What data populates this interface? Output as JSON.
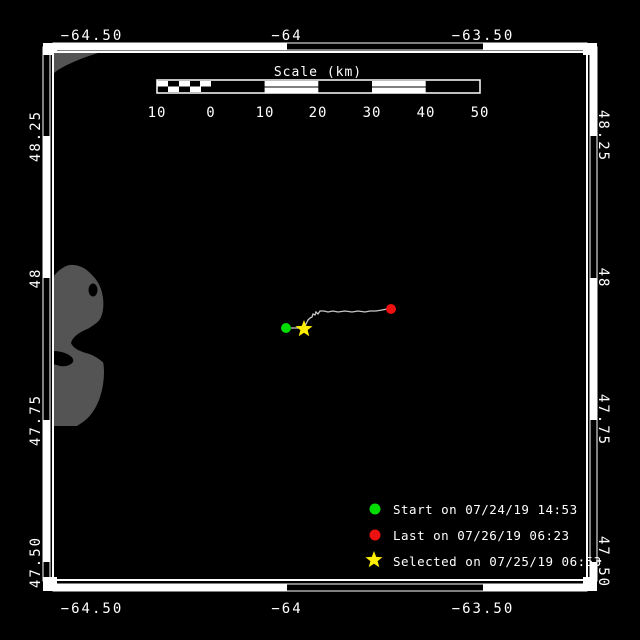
{
  "map": {
    "background": "#000000",
    "land_color": "#545454",
    "frame_color": "#ffffff",
    "lon_labels_top": [
      "−64.50",
      "−64",
      "−63.50"
    ],
    "lon_labels_bottom": [
      "−64.50",
      "−64",
      "−63.50"
    ],
    "lat_labels_left": [
      "48.25",
      "48",
      "47.75",
      "47.50"
    ],
    "lat_labels_right": [
      "48.25",
      "48",
      "47.75",
      "47.50"
    ]
  },
  "scale_bar": {
    "title": "Scale (km)",
    "ticks": [
      "10",
      "0",
      "10",
      "20",
      "30",
      "40",
      "50"
    ]
  },
  "track": {
    "line_color": "#c8c8c8",
    "points": [
      [
        286,
        328
      ],
      [
        294,
        328
      ],
      [
        300,
        328
      ],
      [
        304,
        327
      ],
      [
        306,
        324
      ],
      [
        308,
        320
      ],
      [
        310,
        318
      ],
      [
        312,
        317
      ],
      [
        313,
        314
      ],
      [
        315,
        315
      ],
      [
        316,
        312
      ],
      [
        318,
        314
      ],
      [
        320,
        311
      ],
      [
        324,
        311
      ],
      [
        328,
        312
      ],
      [
        333,
        311
      ],
      [
        338,
        312
      ],
      [
        345,
        311
      ],
      [
        352,
        312
      ],
      [
        358,
        311
      ],
      [
        365,
        312
      ],
      [
        370,
        311
      ],
      [
        376,
        311
      ],
      [
        382,
        310
      ],
      [
        387,
        309
      ],
      [
        391,
        309
      ]
    ],
    "start": {
      "x": 286,
      "y": 328,
      "color": "#00dd00"
    },
    "last": {
      "x": 391,
      "y": 309,
      "color": "#ee1111"
    },
    "selected": {
      "x": 304,
      "y": 329,
      "color": "#ffee00"
    }
  },
  "legend": {
    "items": [
      {
        "symbol": "start-dot",
        "color": "#00dd00",
        "label": "Start on 07/24/19 14:53"
      },
      {
        "symbol": "last-dot",
        "color": "#ee1111",
        "label": "Last on 07/26/19 06:23"
      },
      {
        "symbol": "selected-star",
        "color": "#ffee00",
        "label": "Selected on 07/25/19 06:53"
      }
    ]
  }
}
